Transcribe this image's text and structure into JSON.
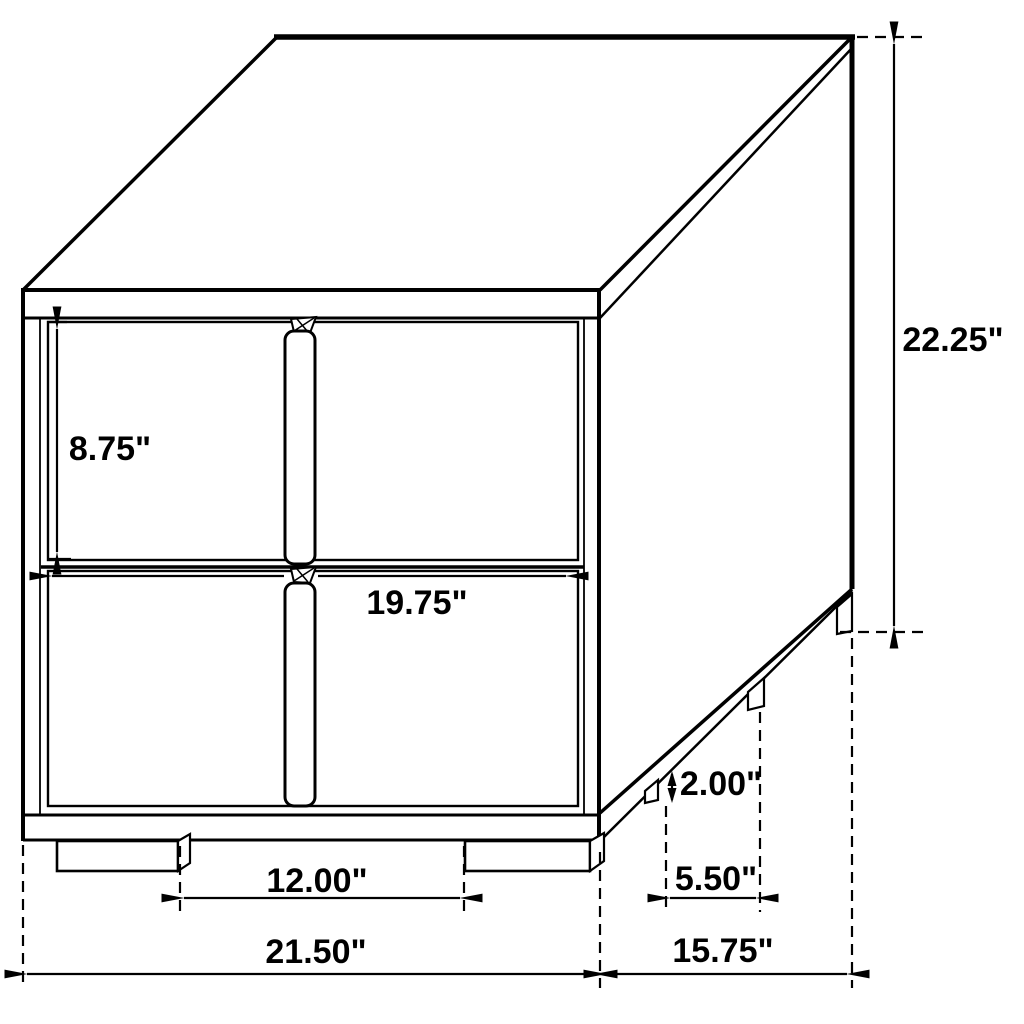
{
  "style": {
    "line_color": "#000000",
    "background_color": "#ffffff"
  },
  "dimensions": {
    "overall_height": {
      "label": "22.25\"",
      "value_inches": 22.25
    },
    "overall_width": {
      "label": "21.50\"",
      "value_inches": 21.5
    },
    "overall_depth": {
      "label": "15.75\"",
      "value_inches": 15.75
    },
    "drawer_height": {
      "label": "8.75\"",
      "value_inches": 8.75
    },
    "drawer_width": {
      "label": "19.75\"",
      "value_inches": 19.75
    },
    "leg_height": {
      "label": "2.00\"",
      "value_inches": 2.0
    },
    "front_leg_spacing": {
      "label": "12.00\"",
      "value_inches": 12.0
    },
    "side_leg_spacing": {
      "label": "5.50\"",
      "value_inches": 5.5
    }
  }
}
